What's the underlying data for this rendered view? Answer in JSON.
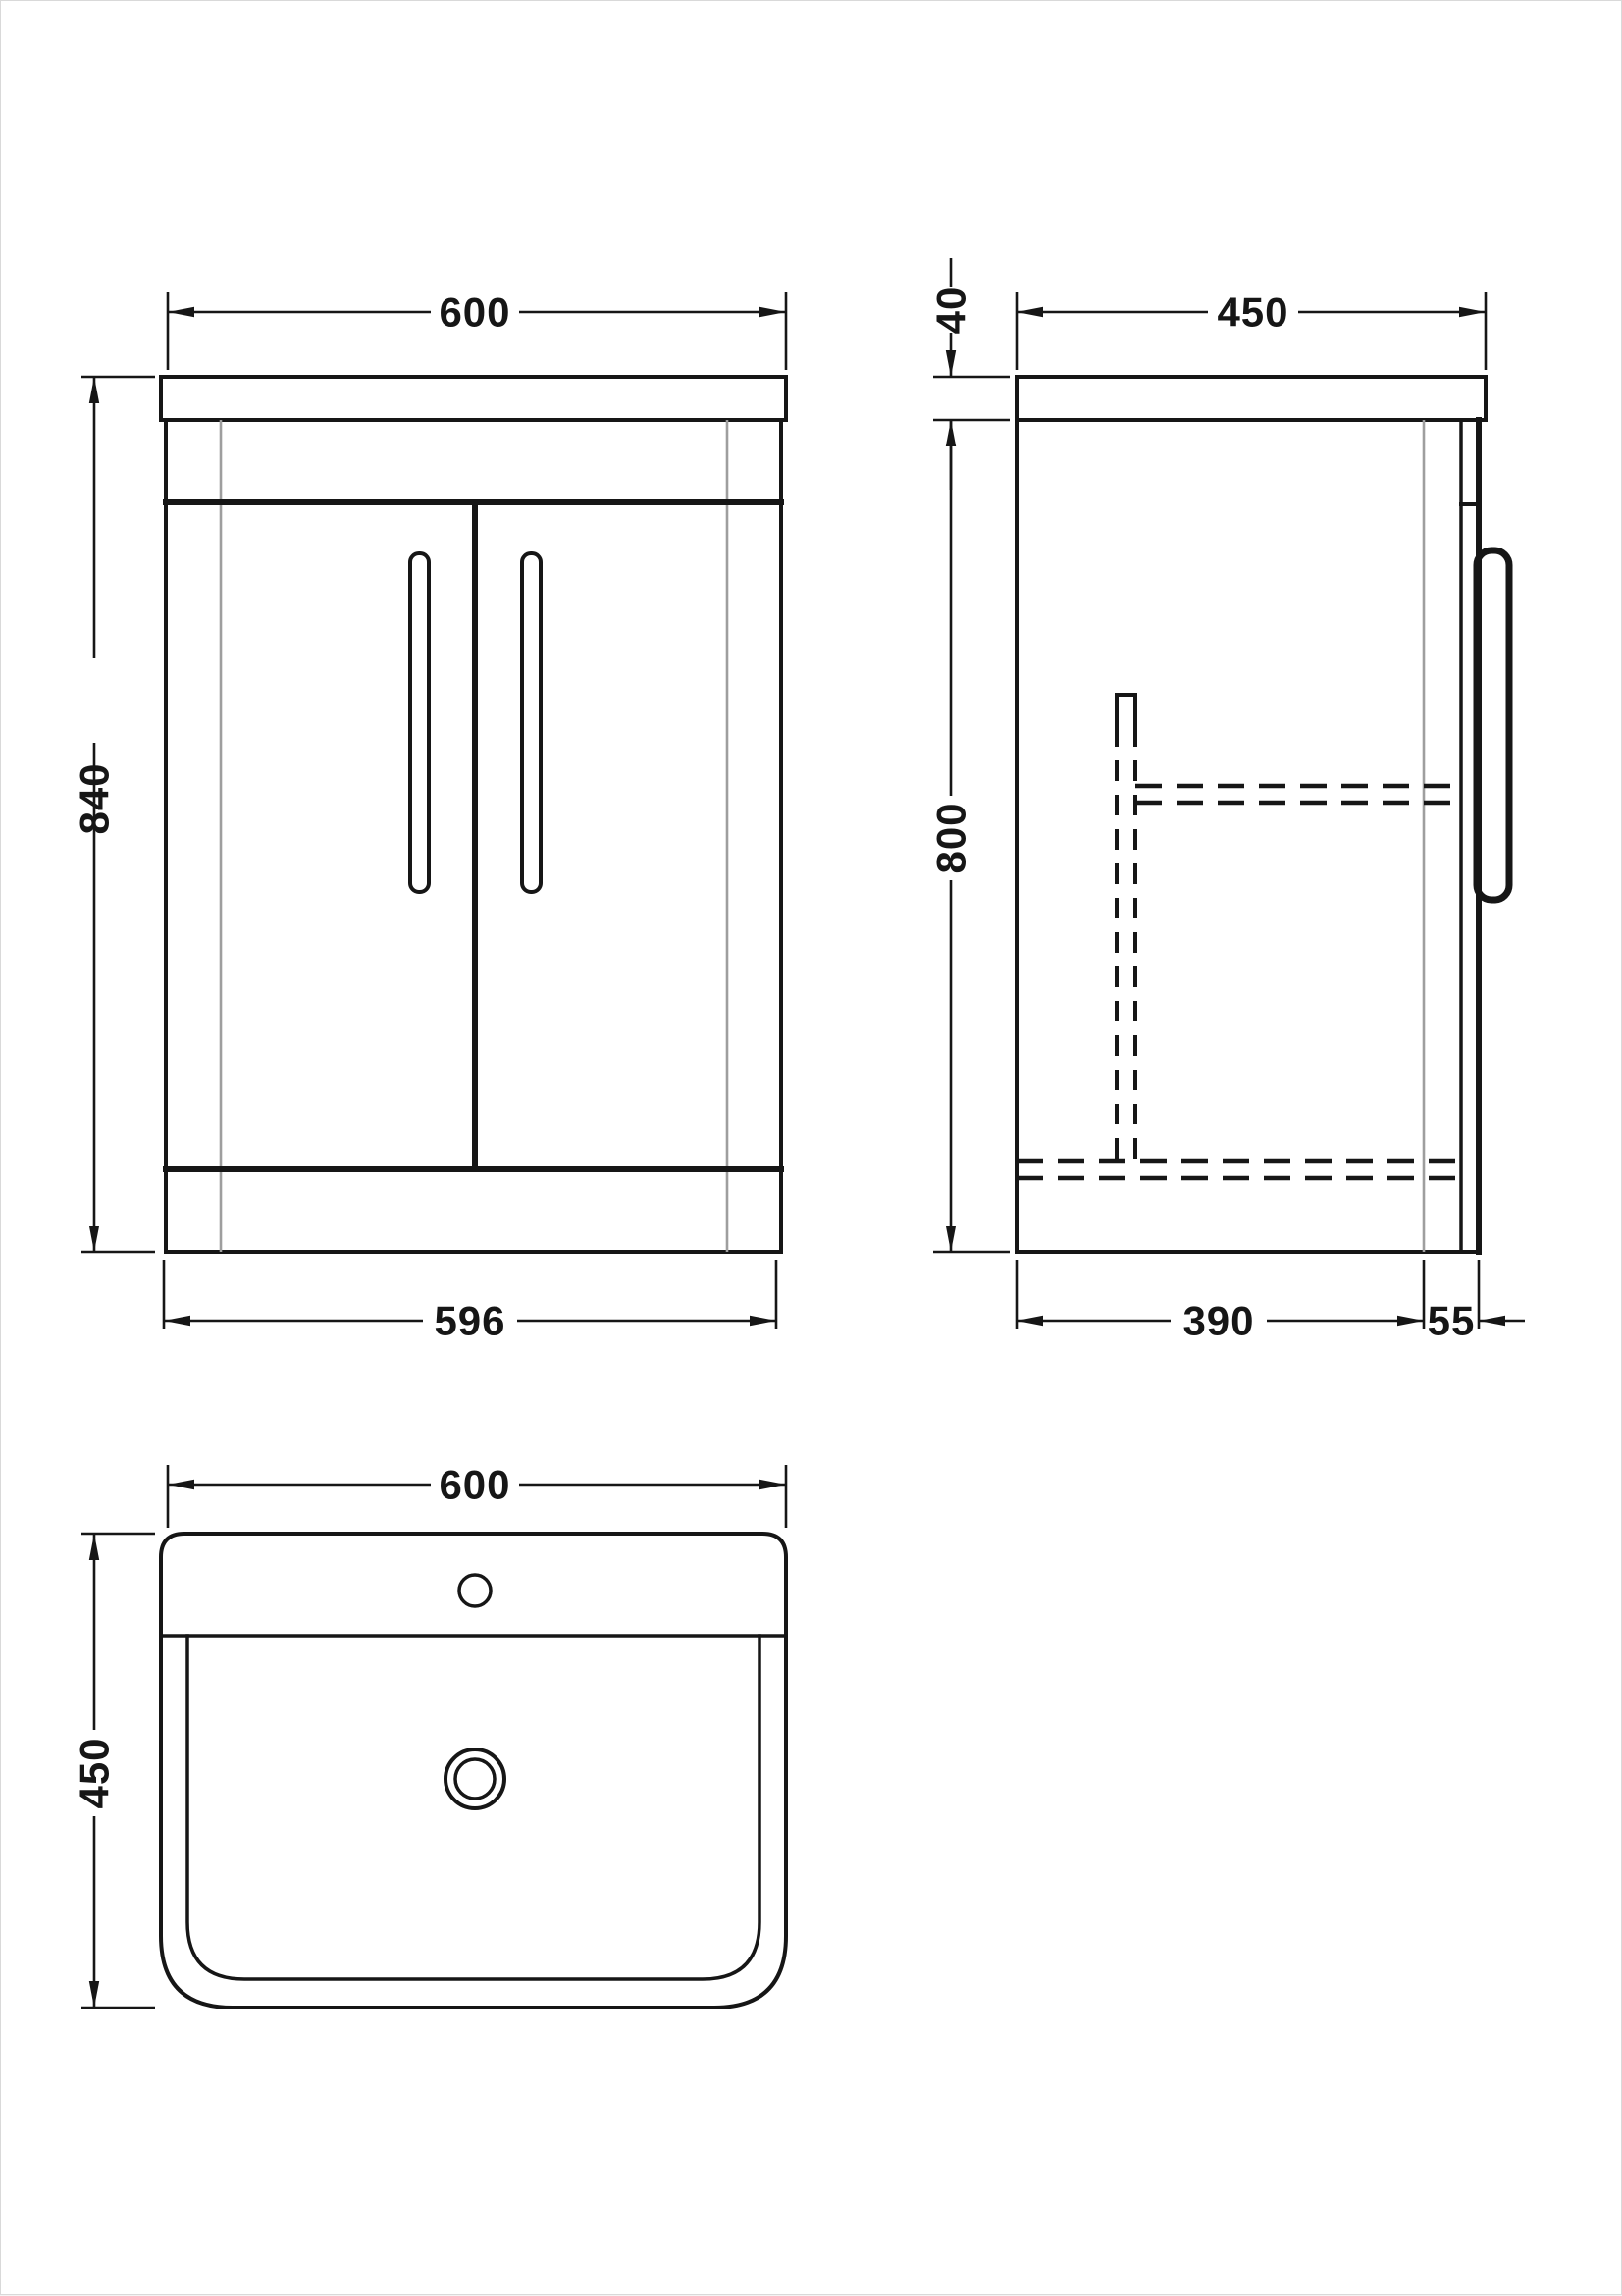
{
  "drawing": {
    "front": {
      "width_top": "600",
      "height": "840",
      "width_bottom": "596"
    },
    "side": {
      "depth_top": "450",
      "counter_thickness": "40",
      "height": "800",
      "depth_carcass": "390",
      "door_offset": "55"
    },
    "plan": {
      "width": "600",
      "depth": "450"
    }
  },
  "colors": {
    "line": "#161616",
    "gray": "#9e9e9e",
    "bg": "#ffffff"
  }
}
